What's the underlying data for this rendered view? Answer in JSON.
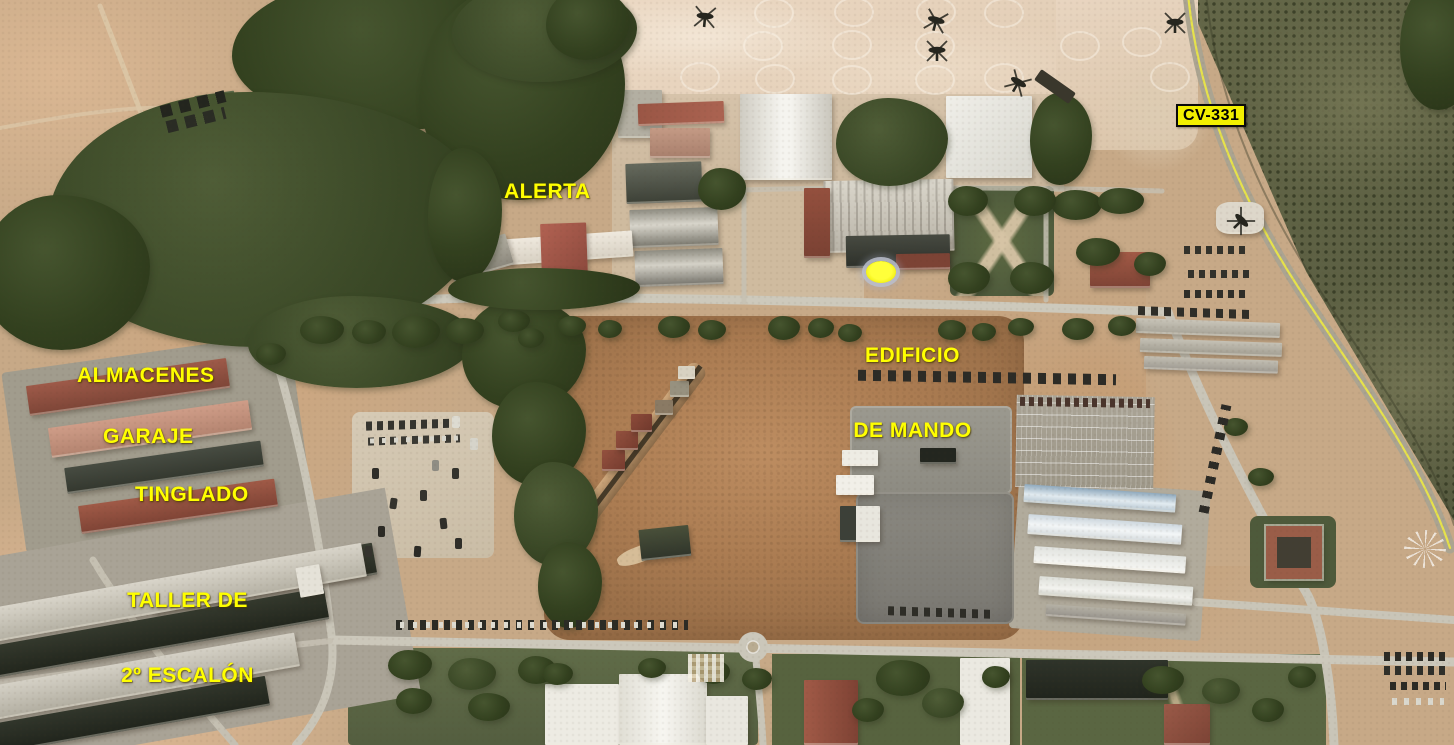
{
  "map": {
    "type": "satellite-annotated",
    "subject": "aerial view of military helicopter base with annotated facilities",
    "annotation_color": "#ffff00",
    "labels": {
      "alerta": "ALERTA",
      "almacenes": "ALMACENES",
      "garaje": "GARAJE",
      "tinglado": "TINGLADO",
      "taller_line1": "TALLER DE",
      "taller_line2": "2º ESCALÓN",
      "edificio_line1": "EDIFICIO",
      "edificio_line2": "DE MANDO"
    },
    "road_sign": {
      "label": "CV-331"
    },
    "marker": {
      "name": "edificio-de-mando-marker",
      "color": "#ffff00"
    }
  }
}
